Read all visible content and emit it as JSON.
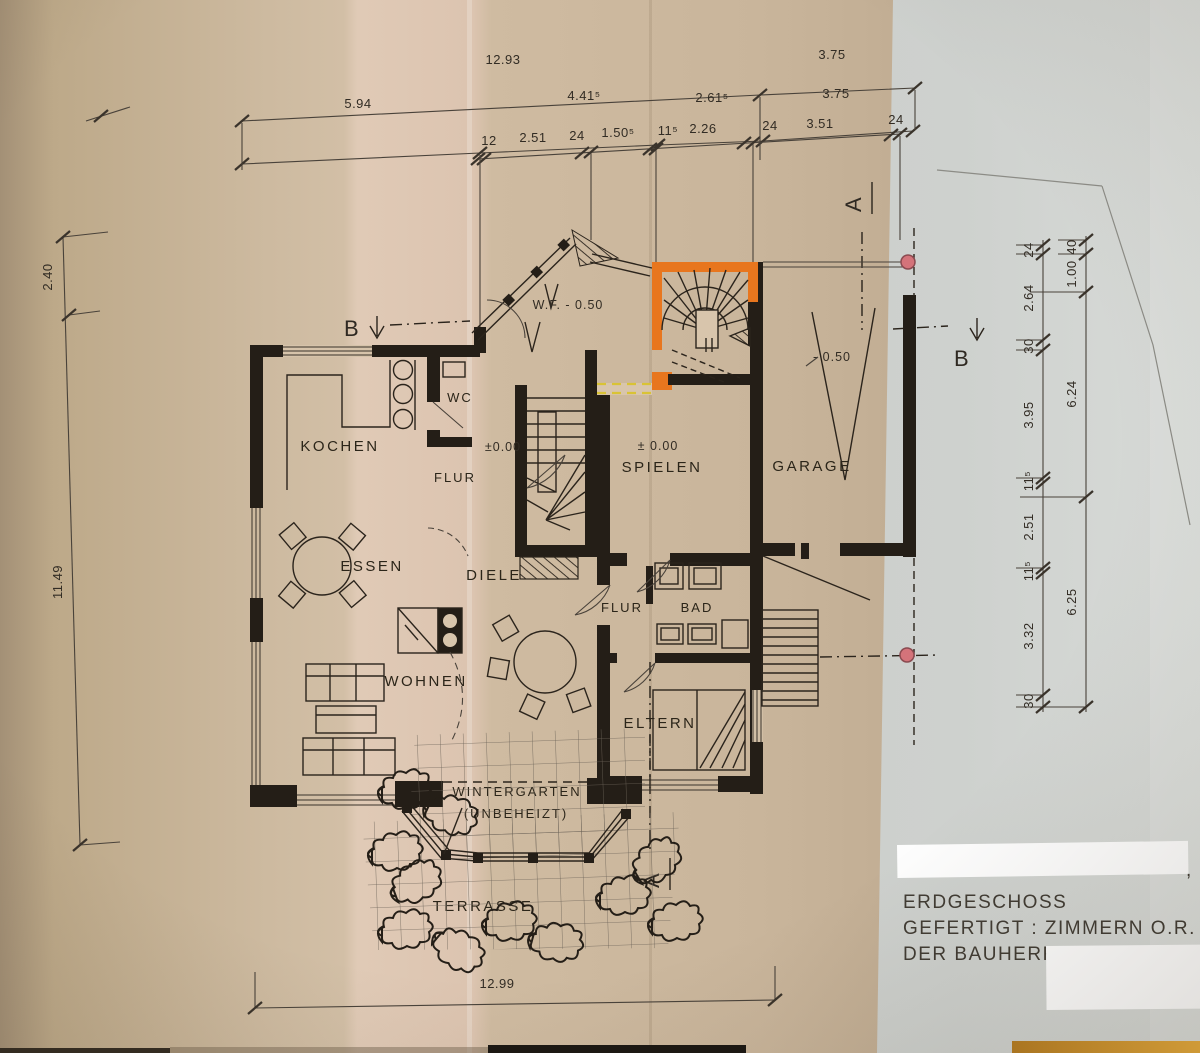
{
  "labels": {
    "rooms": {
      "kochen": "KOCHEN",
      "essen": "ESSEN",
      "wohnen": "WOHNEN",
      "flur_left": "FLUR",
      "wc": "WC",
      "diele": "DIELE",
      "spielen": "SPIELEN",
      "garage": "GARAGE",
      "flur_right": "FLUR",
      "bad": "BAD",
      "eltern": "ELTERN",
      "wintergarten": "WINTERGARTEN",
      "wintergarten_note": "(UNBEHEIZT)",
      "terrasse": "TERRASSE"
    },
    "levels": {
      "wf": "W.F. - 0.50",
      "flur": "±0.00",
      "spielen": "± 0.00",
      "garage": "- 0.50"
    },
    "sections": {
      "a": "A",
      "b": "B"
    }
  },
  "dims": {
    "top1": [
      "12.93",
      "3.75"
    ],
    "top2": [
      "5.94",
      "4.41⁵",
      "2.61⁵",
      "3.75"
    ],
    "top3": [
      "12",
      "2.51",
      "24",
      "1.50⁵",
      "11⁵",
      "2.26",
      "24",
      "3.51",
      "24"
    ],
    "left": [
      "2.40",
      "11.49"
    ],
    "right_inner": [
      "24",
      "2.64",
      "30",
      "3.95",
      "11⁵",
      "2.51",
      "11⁵",
      "3.32",
      "30"
    ],
    "right_outer": [
      "40",
      "1.00",
      "6.24",
      "6.25"
    ],
    "bottom": [
      "12.99"
    ]
  },
  "title_block": {
    "floor": "ERDGESCHOSS",
    "made": "GEFERTIGT : ZIMMERN   O.R.",
    "client": "DER BAUHERR:",
    "comma": ","
  },
  "colors": {
    "ink": "#2b241c",
    "wall": "#241e17",
    "orange_wall": "#e8761e",
    "red_dot": "#d4737a",
    "yellow_dash": "#d9c335",
    "paper_tan": "#cbb79d",
    "paper_pink": "#dcc4b2",
    "paper_gray": "#c8cbc8"
  }
}
